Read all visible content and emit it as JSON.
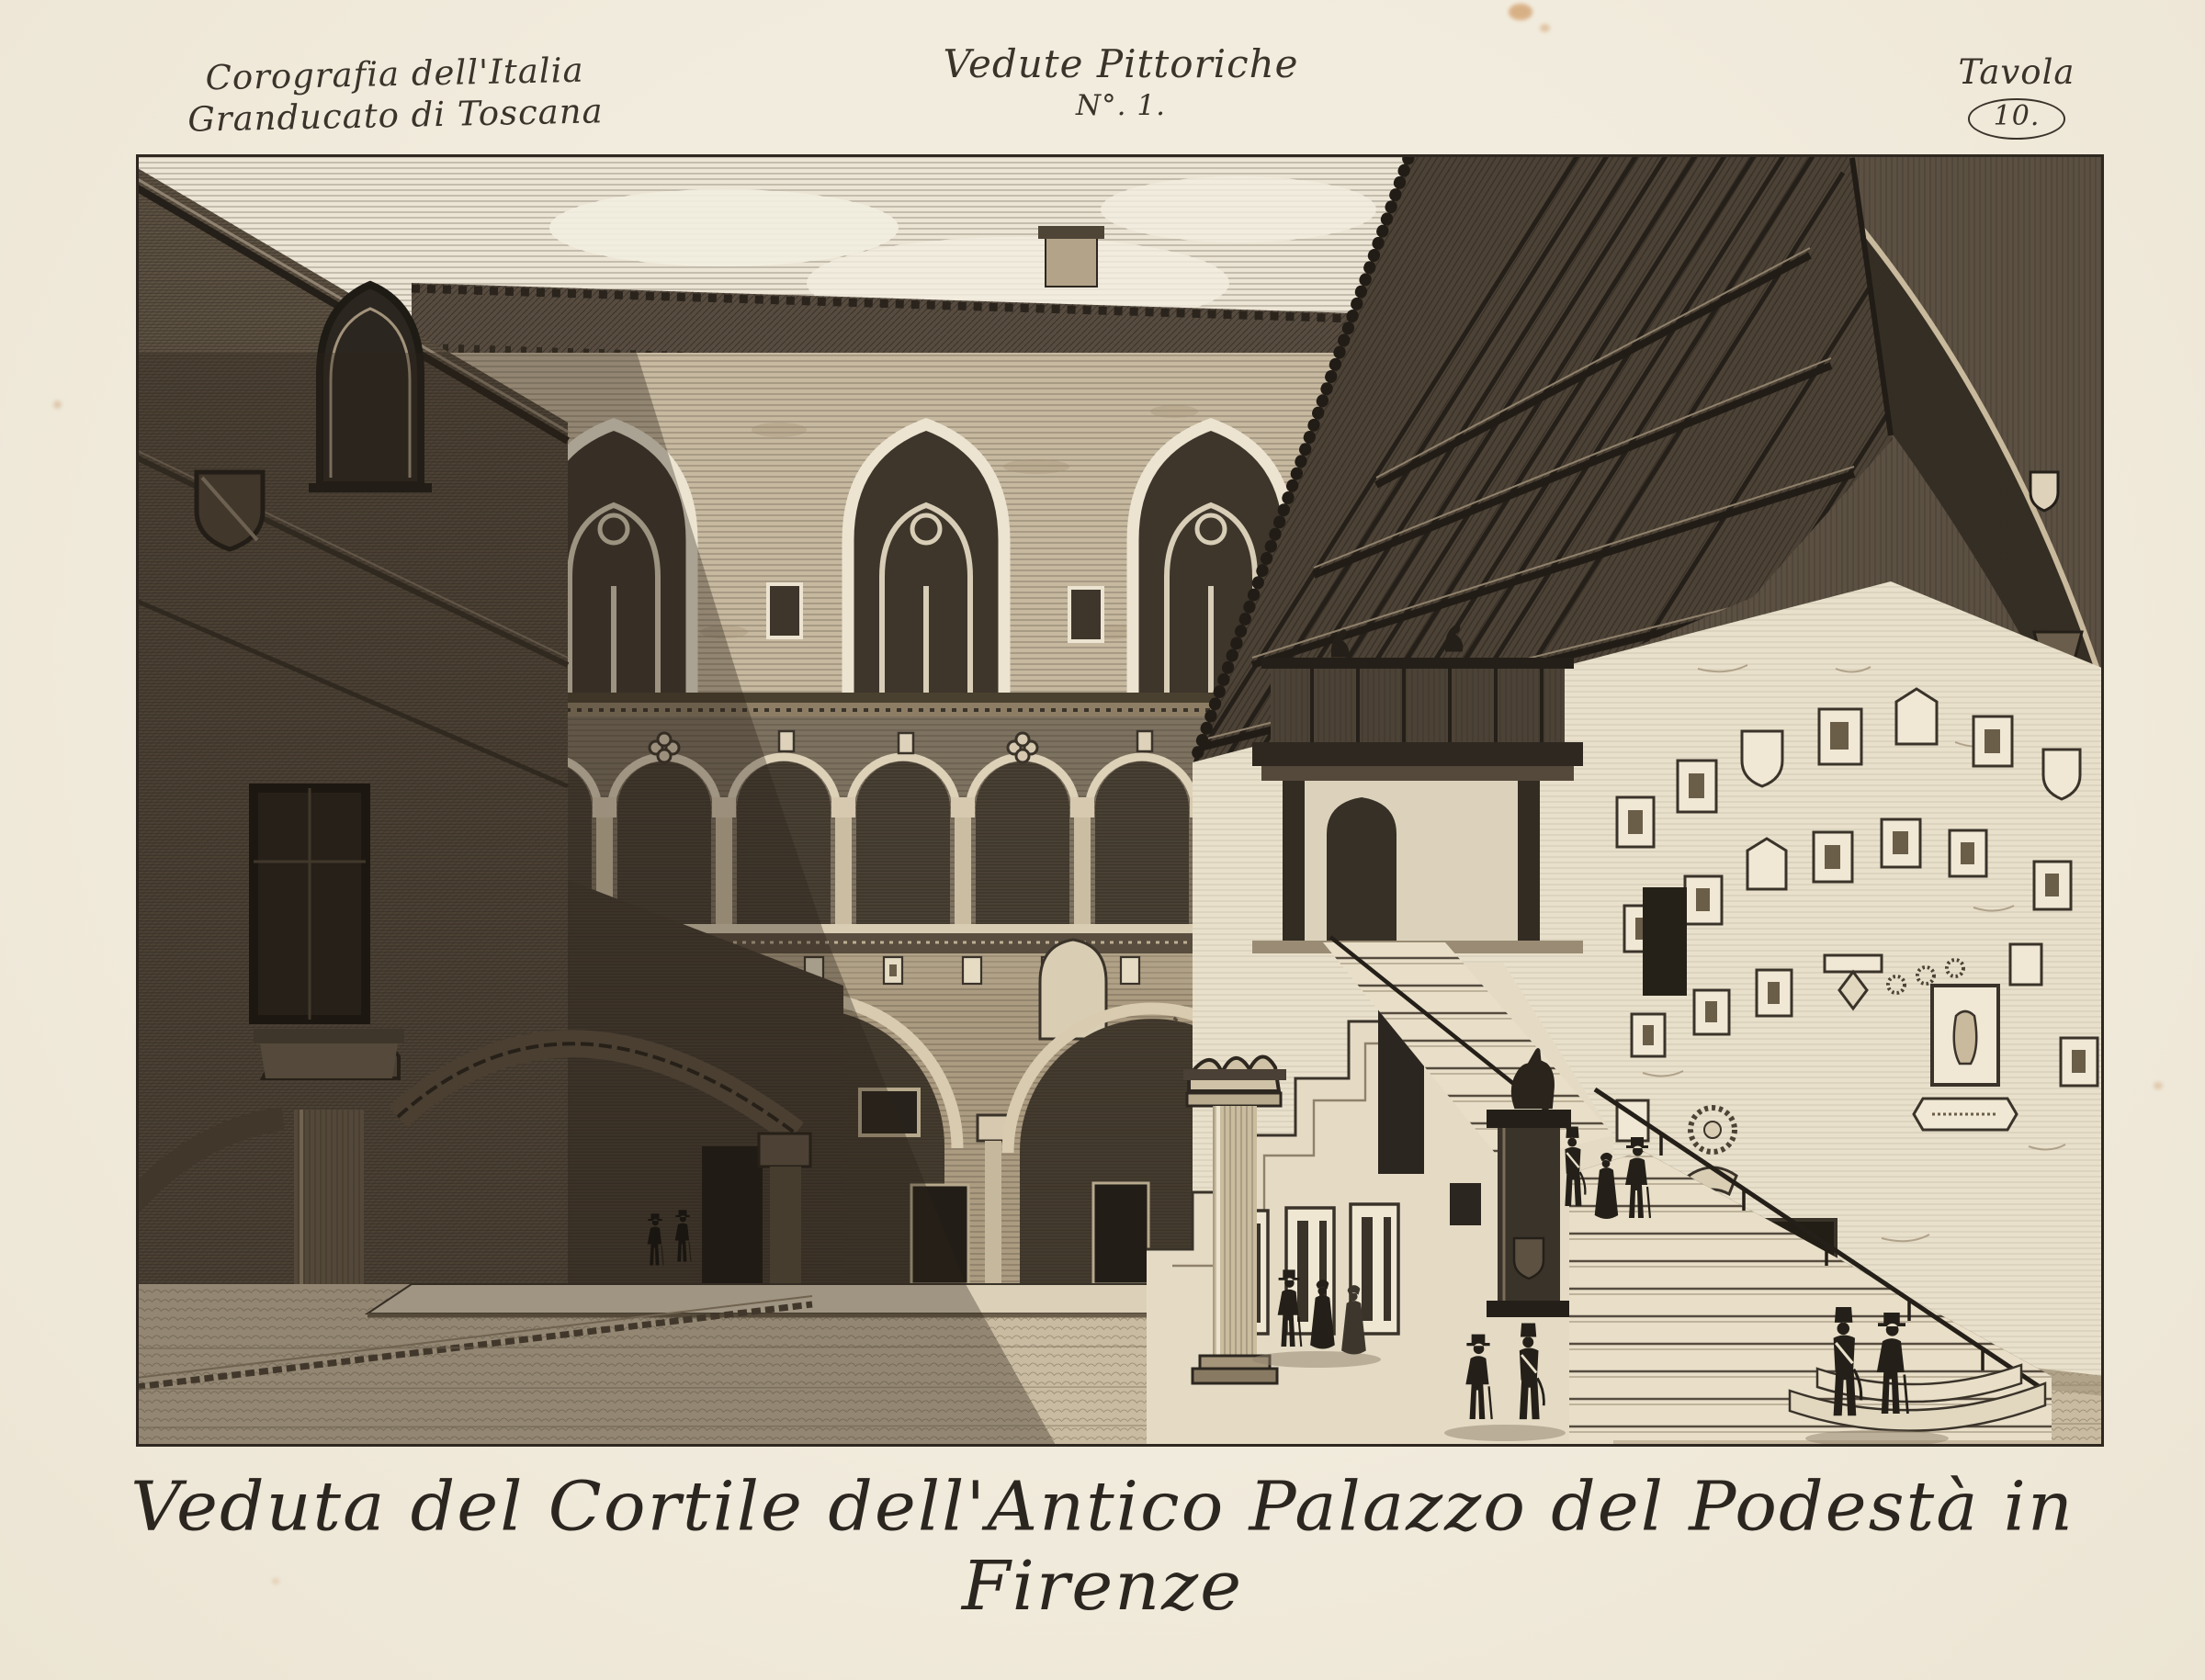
{
  "document": {
    "series": {
      "line1": "Corografia dell'Italia",
      "line2": "Granducato di Toscana"
    },
    "collection": {
      "line1": "Vedute Pittoriche",
      "line2": "N°. 1."
    },
    "plate": {
      "label": "Tavola",
      "number": "10."
    },
    "caption": "Veduta del Cortile dell'Antico Palazzo del Podestà in Firenze"
  },
  "artwork": {
    "medium": "copper engraving on laid paper",
    "subject": "Courtyard of the old Palazzo del Podestà (Bargello) in Florence",
    "elements": [
      "brick wing in shadow with gothic hooded window and carved shield",
      "rear facade with three pointed twin-light windows and tiled eaves with chimney",
      "arcaded loggia of round arches on slender columns with quatrefoil reliefs",
      "band of small heraldic plaques and great ground-floor arches",
      "monumental open staircase with railing, canopied landing and timber truss roof",
      "statues of falcons on the landing parapet and a hound on a dark pedestal",
      "sunlit wall covered with sculpted coats of arms, wreaths and a cherub",
      "strolling figures: soldiers in shakos, men in top hats, women in bonnets",
      "strong diagonal cast shadow across courtyard pavement"
    ],
    "palette": {
      "paper": "#f1ebdd",
      "ink": "#2d2720",
      "dark_shadow": "#4f4438",
      "mid_brick": "#b7a78e",
      "light_stone": "#eae1cd"
    }
  }
}
